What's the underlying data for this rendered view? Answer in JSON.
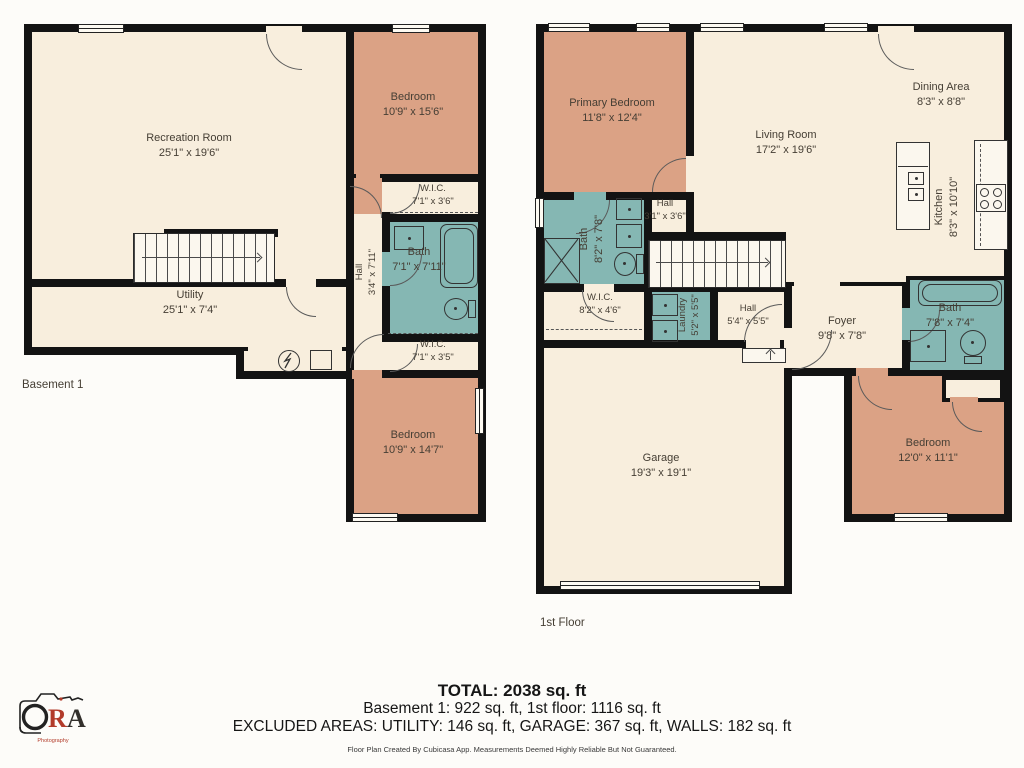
{
  "palette": {
    "wall": "#131313",
    "floor_cream": "#f8eedd",
    "bedroom_salmon": "#dba285",
    "bath_teal": "#85b7b3",
    "background": "#fdfcf9",
    "logo_red": "#b23b2a",
    "label_text": "#453e34"
  },
  "floors": {
    "basement": {
      "label": "Basement 1",
      "rooms": {
        "recreation": {
          "name": "Recreation Room",
          "dims": "25'1\" x 19'6\""
        },
        "bedroom_upper": {
          "name": "Bedroom",
          "dims": "10'9\" x 15'6\""
        },
        "wic_upper": {
          "name": "W.I.C.",
          "dims": "7'1\" x 3'6\""
        },
        "hall": {
          "name": "Hall",
          "dims": "3'4\" x 7'11\""
        },
        "bath": {
          "name": "Bath",
          "dims": "7'1\" x 7'11\""
        },
        "utility": {
          "name": "Utility",
          "dims": "25'1\" x 7'4\""
        },
        "wic_lower": {
          "name": "W.I.C.",
          "dims": "7'1\" x 3'5\""
        },
        "bedroom_lower": {
          "name": "Bedroom",
          "dims": "10'9\" x 14'7\""
        }
      }
    },
    "first": {
      "label": "1st Floor",
      "rooms": {
        "primary_bedroom": {
          "name": "Primary Bedroom",
          "dims": "11'8\" x 12'4\""
        },
        "living": {
          "name": "Living Room",
          "dims": "17'2\" x 19'6\""
        },
        "dining": {
          "name": "Dining Area",
          "dims": "8'3\" x 8'8\""
        },
        "kitchen": {
          "name": "Kitchen",
          "dims": "8'3\" x 10'10\""
        },
        "bath_main": {
          "name": "Bath",
          "dims": "8'2\" x 7'8\""
        },
        "hall_upper": {
          "name": "Hall",
          "dims": "3'1\" x 3'6\""
        },
        "wic": {
          "name": "W.I.C.",
          "dims": "8'2\" x 4'6\""
        },
        "laundry": {
          "name": "Laundry",
          "dims": "5'2\" x 5'5\""
        },
        "hall_lower": {
          "name": "Hall",
          "dims": "5'4\" x 5'5\""
        },
        "foyer": {
          "name": "Foyer",
          "dims": "9'8\" x 7'8\""
        },
        "bath_hall": {
          "name": "Bath",
          "dims": "7'8\" x 7'4\""
        },
        "bedroom": {
          "name": "Bedroom",
          "dims": "12'0\" x 11'1\""
        },
        "garage": {
          "name": "Garage",
          "dims": "19'3\" x 19'1\""
        }
      }
    }
  },
  "footer": {
    "total": "TOTAL: 2038 sq. ft",
    "floor_totals": "Basement 1: 922 sq. ft, 1st floor: 1116 sq. ft",
    "excluded": "EXCLUDED AREAS: UTILITY: 146 sq. ft, GARAGE: 367 sq. ft, WALLS: 182 sq. ft",
    "disclaimer": "Floor Plan Created By Cubicasa App. Measurements Deemed Highly Reliable But Not Guaranteed."
  },
  "logo": {
    "letter_r": "R",
    "letter_a": "A",
    "subtext": "Photography"
  }
}
